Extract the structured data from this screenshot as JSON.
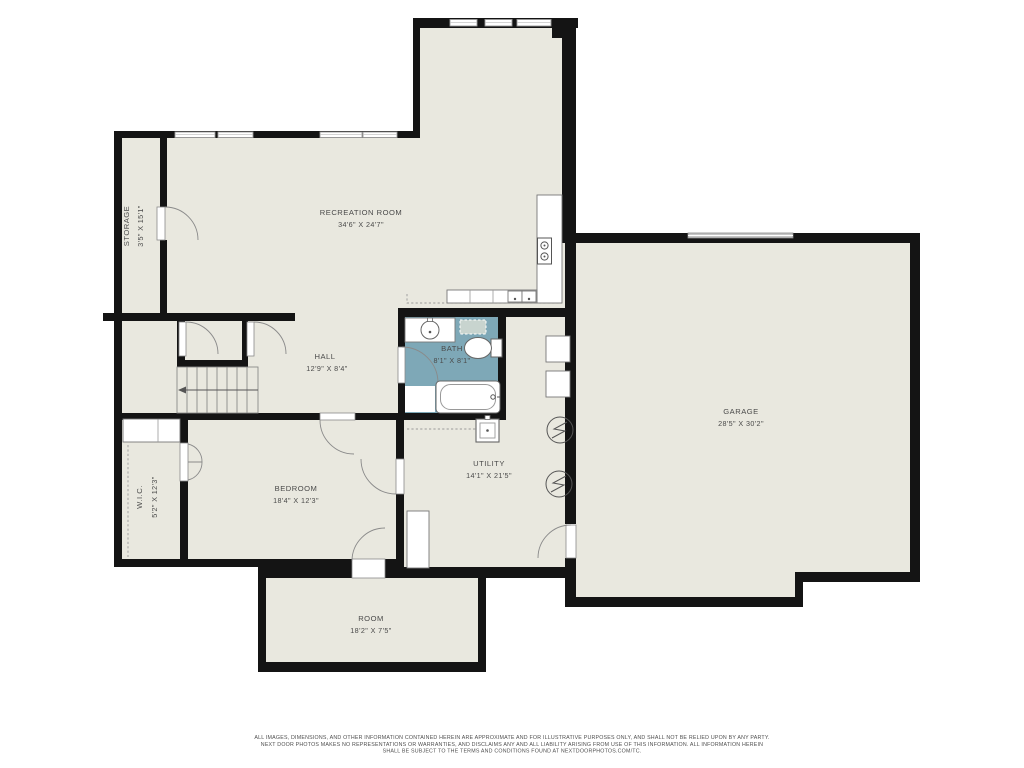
{
  "plan": {
    "rooms": [
      {
        "name": "STORAGE",
        "dims": "3'5\" X 15'1\""
      },
      {
        "name": "RECREATION ROOM",
        "dims": "34'6\" X 24'7\""
      },
      {
        "name": "HALL",
        "dims": "12'9\" X 8'4\""
      },
      {
        "name": "BATH",
        "dims": "8'1\" X 8'1\""
      },
      {
        "name": "GARAGE",
        "dims": "28'5\" X 30'2\""
      },
      {
        "name": "W.I.C.",
        "dims": "5'2\" X 12'3\""
      },
      {
        "name": "BEDROOM",
        "dims": "18'4\" X 12'3\""
      },
      {
        "name": "UTILITY",
        "dims": "14'1\" X 21'5\""
      },
      {
        "name": "ROOM",
        "dims": "18'2\" X 7'5\""
      }
    ],
    "colors": {
      "background": "#ffffff",
      "floor": "#e9e8df",
      "bath_floor": "#7ea8b7",
      "wall": "#141414",
      "fixture_line": "#8a8a8a"
    },
    "disclaimer": {
      "line1": "ALL IMAGES, DIMENSIONS, AND OTHER INFORMATION CONTAINED HEREIN ARE APPROXIMATE AND FOR ILLUSTRATIVE PURPOSES ONLY, AND SHALL NOT BE RELIED UPON BY ANY PARTY.",
      "line2": "NEXT DOOR PHOTOS MAKES NO REPRESENTATIONS OR WARRANTIES, AND DISCLAIMS ANY AND ALL LIABILITY ARISING FROM USE OF THIS INFORMATION. ALL INFORMATION HEREIN",
      "line3": "SHALL BE SUBJECT TO THE TERMS AND CONDITIONS FOUND AT NEXTDOORPHOTOS.COM/TC."
    }
  }
}
